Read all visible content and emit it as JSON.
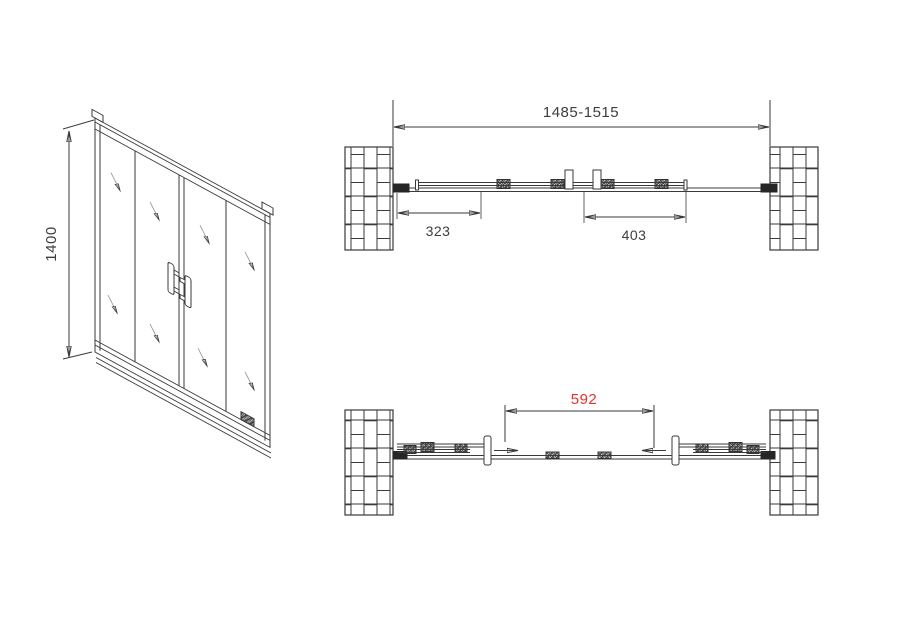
{
  "colors": {
    "background": "#ffffff",
    "line": "#3a3a3a",
    "dim_text": "#3d3d3d",
    "accent_red": "#e8312f"
  },
  "iso_view": {
    "height_dim_label": "1400"
  },
  "plan_closed": {
    "overall_width_label": "1485-1515",
    "left_offset_label": "323",
    "door_width_label": "403"
  },
  "plan_open": {
    "opening_width_label": "592"
  }
}
